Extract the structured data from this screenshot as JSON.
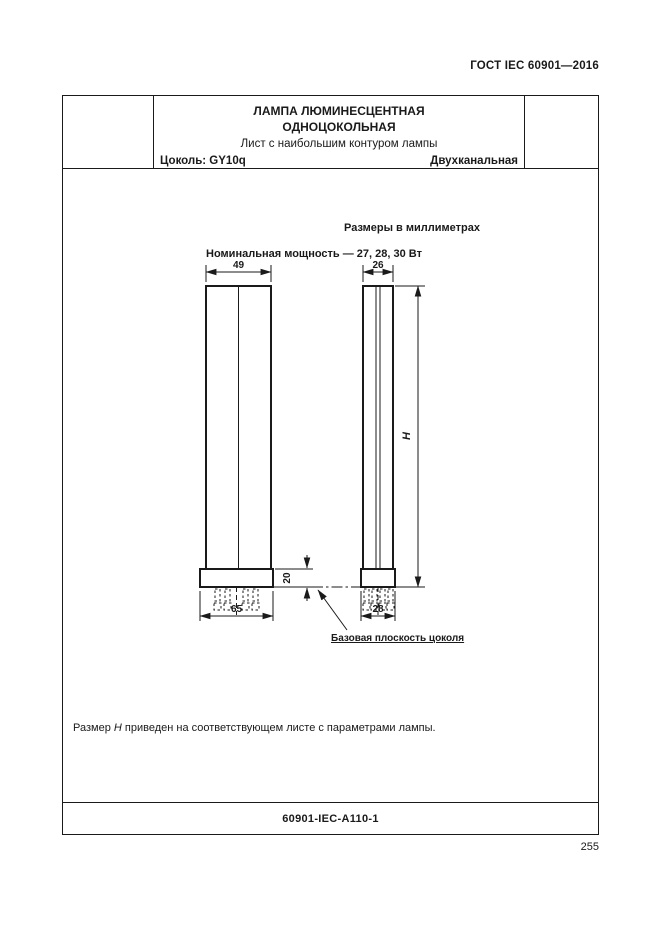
{
  "page": {
    "header": "ГОСТ IEC 60901—2016",
    "page_number": "255"
  },
  "title_block": {
    "title_line1": "ЛАМПА ЛЮМИНЕСЦЕНТНАЯ",
    "title_line2": "ОДНОЦОКОЛЬНАЯ",
    "subtitle": "Лист с наибольшим контуром лампы",
    "cap": "Цоколь: GY10q",
    "channels": "Двухканальная"
  },
  "drawing": {
    "units_note": "Размеры в миллиметрах",
    "power_note": "Номинальная мощность — 27, 28, 30 Вт",
    "dims": {
      "front_tube_width": "49",
      "side_tube_width": "26",
      "front_base_width": "65",
      "side_base_width": "28",
      "base_height": "20",
      "overall_height": "H"
    },
    "base_plane_label": "Базовая плоскость цоколя"
  },
  "note": {
    "prefix": "Размер",
    "symbol": "H",
    "rest": "приведен на соответствующем листе с параметрами лампы."
  },
  "footer": {
    "sheet_ref": "60901-IEC-A110-1"
  }
}
